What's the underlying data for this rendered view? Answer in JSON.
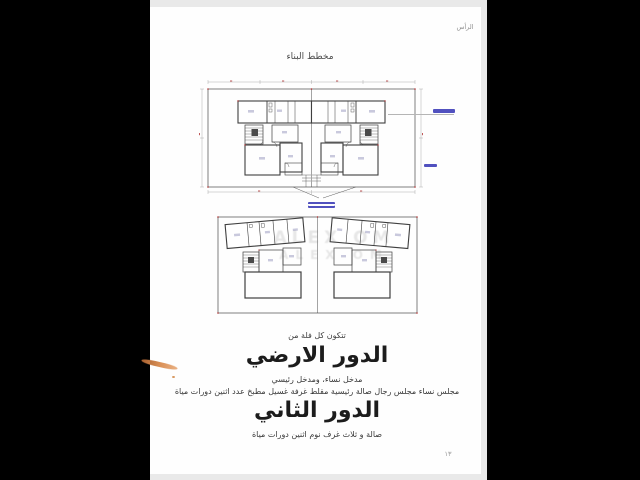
{
  "page": {
    "running_head": "الرأس",
    "title": "مخطط البناء",
    "page_number": "١٣"
  },
  "body_text": {
    "intro": "تتكون كل فلة من",
    "ground_heading": "الدور الارضي",
    "ground_line1": "مدخل نساء، ومدخل رئيسي",
    "ground_line2": "مجلس نساء مجلس رجال صالة رئيسية مقلط غرفة غسيل مطبخ عدد اثنين دورات مياة",
    "second_heading": "الدور الثاني",
    "second_line1": "صالة و ثلاث غرف نوم اثنين دورات مياة"
  },
  "watermark": "ALEX OM",
  "colors": {
    "plan_line": "#474747",
    "dimension_red": "#b03030",
    "annotation_blue": "#3232b4",
    "pen_mark_orange": "#d98f55",
    "background": "#000000",
    "page": "#fefefe"
  }
}
